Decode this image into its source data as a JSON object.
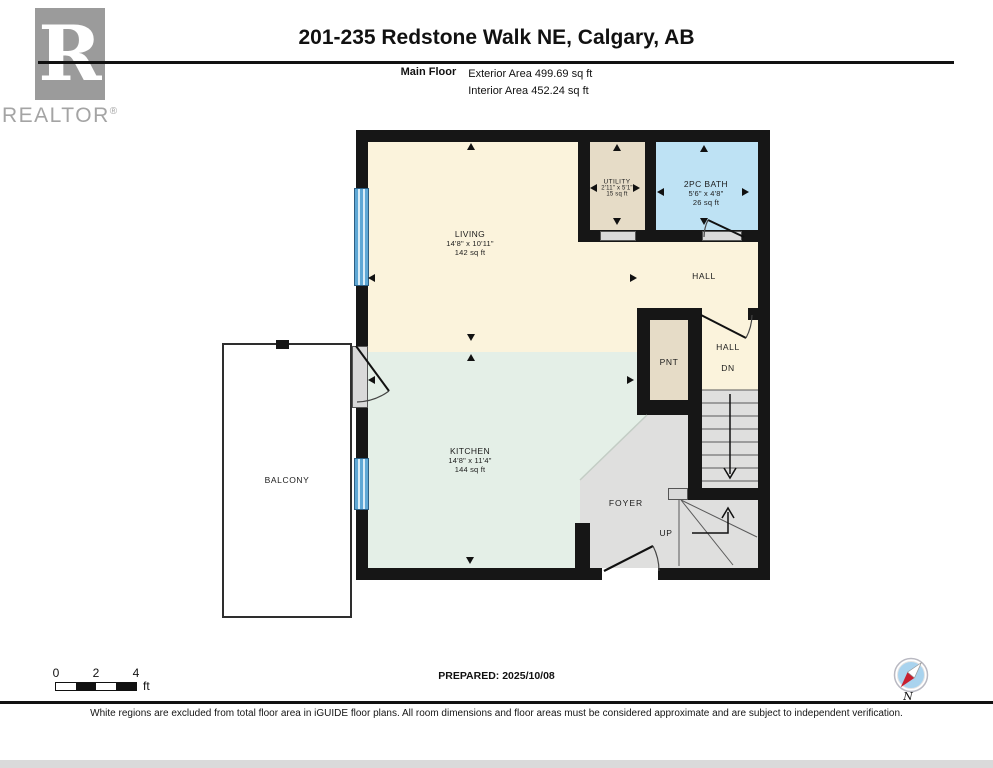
{
  "header": {
    "logo_letter": "R",
    "logo_brand": "REALTOR",
    "logo_registered": "®",
    "title": "201-235 Redstone Walk NE, Calgary, AB",
    "floor_label": "Main Floor",
    "exterior_area": "Exterior Area 499.69 sq ft",
    "interior_area": "Interior Area 452.24 sq ft"
  },
  "rooms": {
    "living": {
      "name": "LIVING",
      "dims": "14'8\" x 10'11\"",
      "area": "142 sq ft"
    },
    "kitchen": {
      "name": "KITCHEN",
      "dims": "14'8\" x 11'4\"",
      "area": "144 sq ft"
    },
    "bath": {
      "name": "2PC BATH",
      "dims": "5'6\" x 4'8\"",
      "area": "26 sq ft"
    },
    "utility": {
      "name": "UTILITY",
      "dims": "2'11\" x 5'1\"",
      "area": "15 sq ft"
    }
  },
  "labels": {
    "hall_upper": "HALL",
    "hall_lower": "HALL",
    "down": "DN",
    "up": "UP",
    "pantry": "PNT",
    "foyer": "FOYER",
    "balcony": "BALCONY"
  },
  "footer": {
    "scale": {
      "tick_0": "0",
      "tick_2": "2",
      "tick_4": "4",
      "unit": "ft"
    },
    "prepared": "PREPARED: 2025/10/08",
    "compass_north": "N",
    "disclaimer": "White regions are excluded from total floor area in iGUIDE floor plans. All room dimensions and floor areas must be considered approximate and are subject to independent verification."
  },
  "colors": {
    "wall": "#161616",
    "living_hall_floor": "#FBF3DC",
    "kitchen_floor": "#E4EFE7",
    "bath_floor": "#BEE2F4",
    "utility_pantry_floor": "#E6DCC7",
    "foyer_stairs_floor": "#DFDFDE",
    "window_blue": "#5FA8D5",
    "balcony_outline": "#2E2E2E",
    "logo_gray": "#9B9B9B",
    "compass_red": "#C8202F",
    "compass_blue": "#A9D3EE"
  }
}
